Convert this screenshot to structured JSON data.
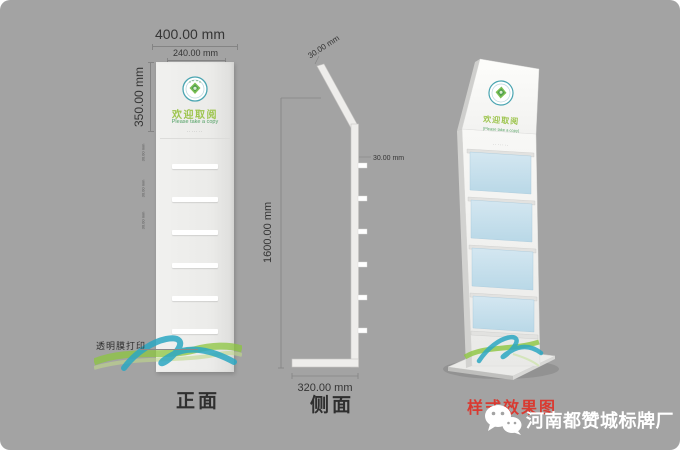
{
  "sheet": {
    "bg": "#a3a3a3"
  },
  "front": {
    "dim_outer_width": "400.00 mm",
    "dim_inner_width": "240.00 mm",
    "dim_header_height": "350.00 mm",
    "small_dim_1": "30.00 mm",
    "small_dim_2": "30.00 mm",
    "small_dim_3": "30.00 mm",
    "logo_icon": "green-leaf-emblem",
    "welcome_cn": "欢迎取阅",
    "welcome_en": "Please take a copy",
    "micro_text": "·······",
    "film_print_label": "透明膜打印",
    "caption": "正面",
    "slot_count": 6
  },
  "side": {
    "dim_top_thickness": "30.00 mm",
    "dim_slot_tab": "30.00 mm",
    "dim_height": "1600.00 mm",
    "dim_base_depth": "320.00 mm",
    "caption": "侧面",
    "tab_count": 6
  },
  "render": {
    "logo_icon": "green-leaf-emblem",
    "welcome_cn": "欢迎取阅",
    "welcome_en": "(Please take a copy)",
    "micro_text": "·······",
    "caption": "样式效果图",
    "pocket_count": 4
  },
  "watermark": {
    "icon": "wechat-icon",
    "text": "河南都赞城标牌厂"
  },
  "colors": {
    "accent_green": "#8fc34f",
    "accent_teal": "#2ba7c2",
    "caption_red": "#d93a31",
    "dim_text": "#3c3c3c",
    "pocket_blue": "#c9e1ee"
  }
}
